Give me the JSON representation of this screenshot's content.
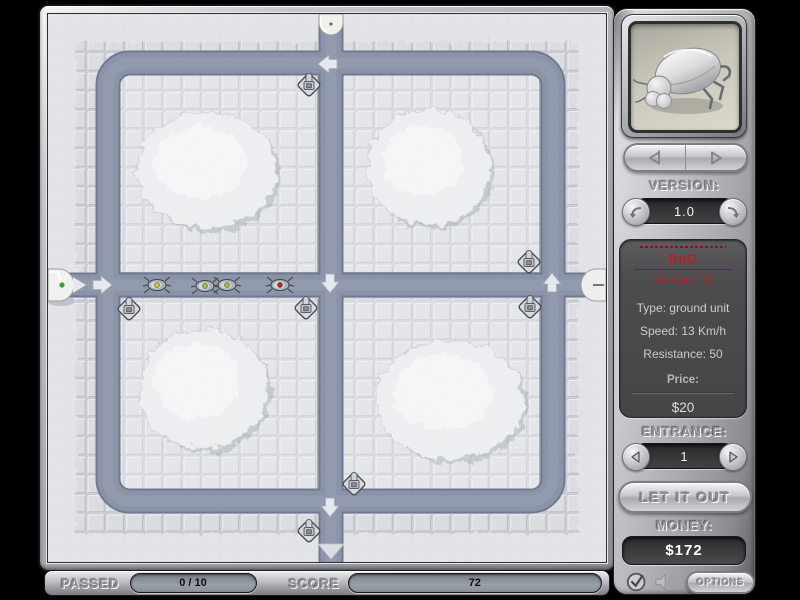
{
  "status_bar": {
    "passed_label": "PASSED",
    "passed_value": "0 / 10",
    "score_label": "SCORE",
    "score_value": "72"
  },
  "sidebar": {
    "version_label": "VERSION:",
    "version_value": "1.0",
    "unit_info": {
      "name": "BuG",
      "version_line": "version 1.0",
      "type_line": "Type: ground unit",
      "speed_line": "Speed: 13 Km/h",
      "resistance_line": "Resistance: 50",
      "price_label": "Price:",
      "price_value": "$20"
    },
    "entrance_label": "ENTRANCE:",
    "entrance_value": "1",
    "release_button_label": "LET IT OUT",
    "money_label": "MONEY:",
    "money_value": "$172",
    "options_button_label": "OPTIONS"
  },
  "board": {
    "arrows": [
      {
        "x": 54,
        "y": 271,
        "dir": "right"
      },
      {
        "x": 280,
        "y": 50,
        "dir": "left"
      },
      {
        "x": 282,
        "y": 269,
        "dir": "down"
      },
      {
        "x": 504,
        "y": 269,
        "dir": "up"
      },
      {
        "x": 282,
        "y": 493,
        "dir": "down"
      }
    ],
    "towers": [
      {
        "x": 261,
        "y": 71
      },
      {
        "x": 81,
        "y": 295
      },
      {
        "x": 258,
        "y": 294
      },
      {
        "x": 481,
        "y": 248
      },
      {
        "x": 482,
        "y": 293
      },
      {
        "x": 306,
        "y": 470
      },
      {
        "x": 261,
        "y": 517
      }
    ],
    "bugs": [
      {
        "x": 109,
        "y": 271,
        "color": "#c8cc1e"
      },
      {
        "x": 157,
        "y": 272,
        "color": "#9cc41e"
      },
      {
        "x": 179,
        "y": 271,
        "color": "#9cc41e"
      },
      {
        "x": 232,
        "y": 271,
        "color": "#cc1e1e"
      }
    ],
    "colors": {
      "path": "#8a93a7",
      "path_edge": "#6e7890",
      "tile": "#dcdee2",
      "entrance_dot": "#3aa03a",
      "unit_text_red": "#b22222"
    }
  }
}
